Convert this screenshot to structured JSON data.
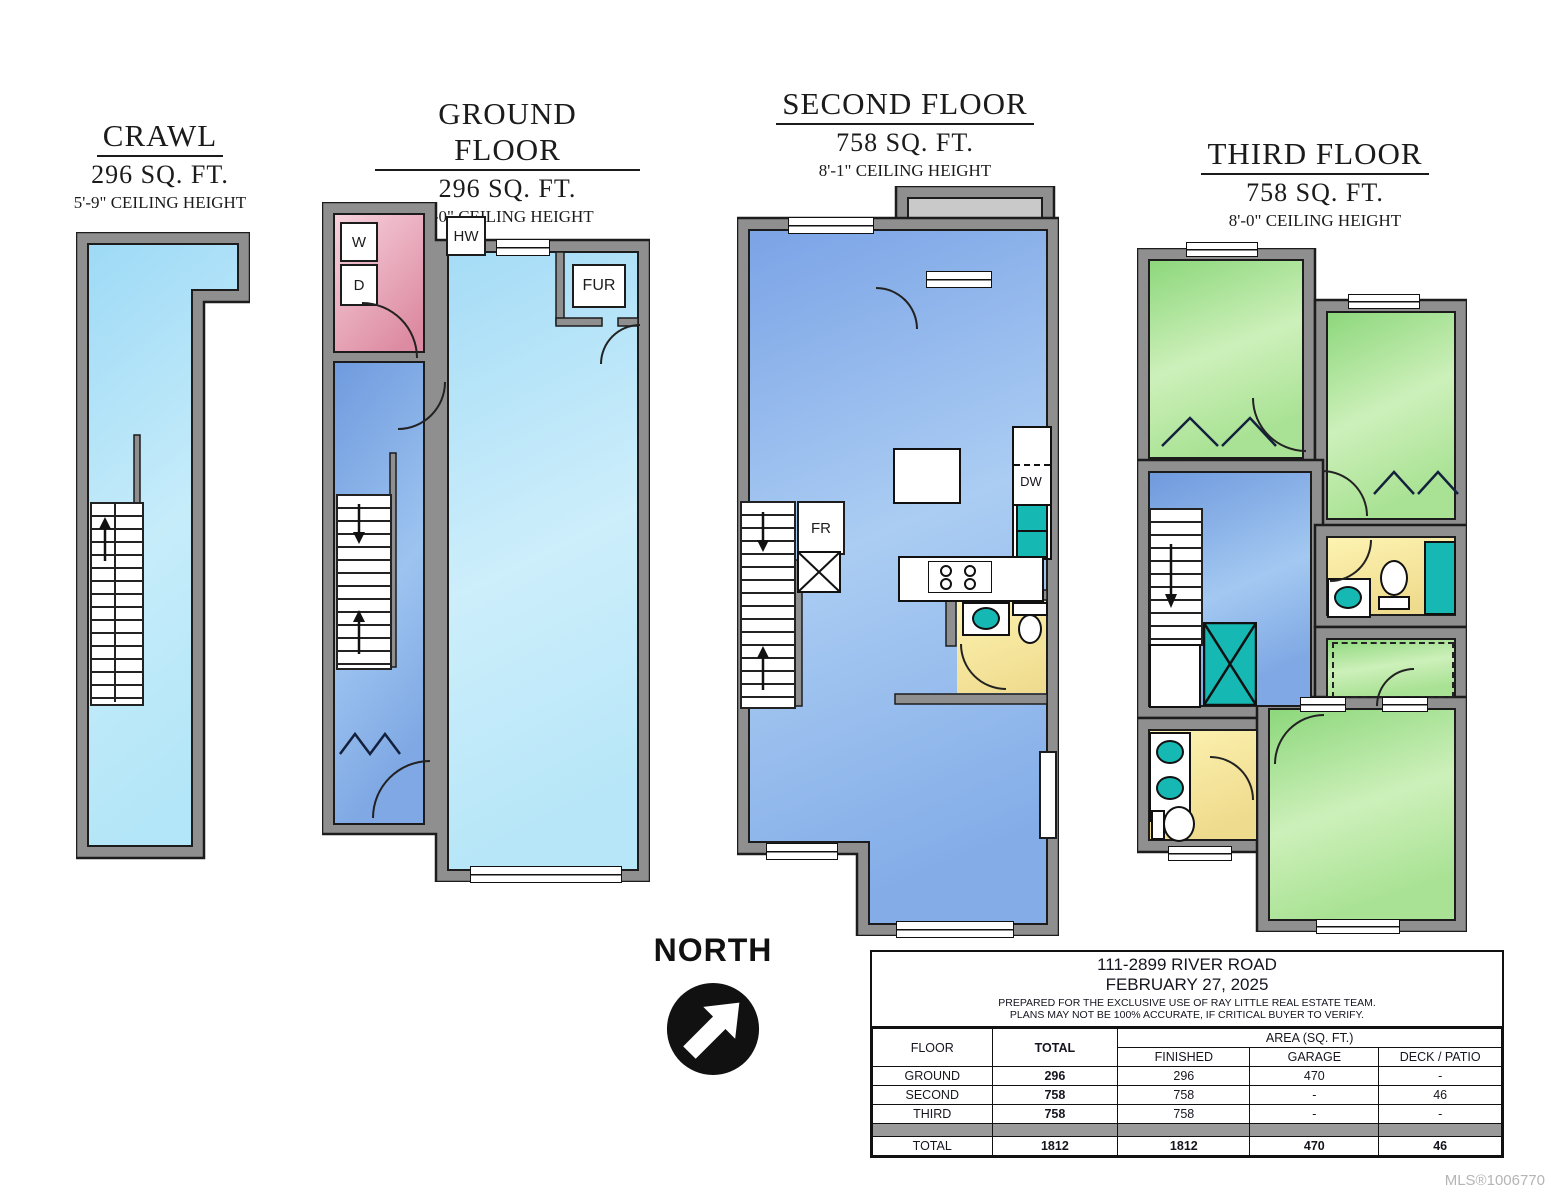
{
  "colors": {
    "wall": "#8f8f8f",
    "teal": "#16b8b4",
    "spacer": "#9a9a9a",
    "crawl_blue": "#a9def7",
    "garage_blue": "#b2e4f8",
    "stair_blue": "#7fa6e2",
    "floor_blue": "#8fb5ec",
    "laundry_pink": "#eeb0c2",
    "bedroom_green": "#a5e18f",
    "bath_yellow": "#f6e9a6",
    "deck_gray": "#c9c9c9"
  },
  "floors": {
    "crawl": {
      "title": "CRAWL",
      "area": "296 SQ. FT.",
      "ceiling": "5'-9\" CEILING HEIGHT",
      "rooms": {
        "crawl_space": {
          "name": "CRAWL SPACE",
          "dims": "6'-5\" x 36'-9\"",
          "note": "5'-9\" CEILING"
        }
      }
    },
    "ground": {
      "title": "GROUND FLOOR",
      "area": "296 SQ. FT.",
      "ceiling": "8'-0\" CEILING HEIGHT",
      "labels": {
        "washer": "W",
        "dryer": "D",
        "hot_water": "HW",
        "furnace": "FUR",
        "dn_to_cr": "DN\nTO\nCR",
        "up": "UP"
      },
      "rooms": {
        "laundry": {
          "name": "LAUNDRY ROOM",
          "dims": "6'-5\" x 9'-0\""
        },
        "entry": {
          "name": "ENTRY",
          "dims": "4'-4\" x 9'-6\""
        },
        "garage": {
          "name": "GARAGE",
          "dims": "11'-10\" x 32'-4\"/36'-9\""
        }
      }
    },
    "second": {
      "title": "SECOND FLOOR",
      "area": "758 SQ. FT.",
      "ceiling": "8'-1\" CEILING HEIGHT",
      "labels": {
        "dn": "DN",
        "up": "UP",
        "fridge": "FR",
        "dishwasher": "DW",
        "fireplace": "FP",
        "half_bath": "2\nPC."
      },
      "rooms": {
        "deck": {
          "name": "DECK",
          "dims": "9'-0\" x 5'-2\""
        },
        "office_nook": {
          "name": "OFFICE NOOK",
          "dims": "9'-0\" x 12'-0\""
        },
        "dining": {
          "name": "DINING ROOM",
          "dims": "9'-6\" x 9'-0\""
        },
        "kitchen": {
          "name": "KITCHEN",
          "dims": "15'-0\" x 9'-7\""
        },
        "living": {
          "name": "LIVING ROOM",
          "dims": "18'-5\"/11'-5\" x 12'-5\""
        }
      }
    },
    "third": {
      "title": "THIRD FLOOR",
      "area": "758 SQ. FT.",
      "ceiling": "8'-0\" CEILING HEIGHT",
      "labels": {
        "dn": "DN",
        "bath": "4 PC.\nBATH",
        "ensuite": "4 PC.\nENS."
      },
      "rooms": {
        "bedroom1": {
          "name": "BEDROOM",
          "dims": "9'-3\" x 10'-3\""
        },
        "bedroom2": {
          "name": "BEDROOM",
          "dims": "9'-1\" x 10'-10\"",
          "note": "8'-1\" CEILING"
        },
        "hallway": {
          "name": "HALLWAY",
          "dims": "10'-4\" x 12'-1\""
        },
        "walk_in_closet": {
          "name": "WALK\nIN\nCLOSET",
          "dims": "6'-0\" x 5'-0\""
        },
        "primary": {
          "name": "PRIMARY BEDROOM",
          "dims": "12'-0\" x 12'-6\""
        }
      }
    }
  },
  "compass": {
    "label": "NORTH"
  },
  "mls": "MLS®1006770",
  "table": {
    "title_line1": "111-2899 RIVER ROAD",
    "title_line2": "FEBRUARY 27, 2025",
    "title_line3": "PREPARED FOR THE EXCLUSIVE USE OF RAY LITTLE REAL ESTATE TEAM.",
    "title_line4": "PLANS MAY NOT BE 100% ACCURATE, IF CRITICAL BUYER TO VERIFY.",
    "col_floor": "FLOOR",
    "col_total": "TOTAL",
    "col_area": "AREA (SQ. FT.)",
    "col_finished": "FINISHED",
    "col_garage": "GARAGE",
    "col_deck": "DECK / PATIO",
    "rows": [
      {
        "floor": "GROUND",
        "total": "296",
        "finished": "296",
        "garage": "470",
        "deck": "-"
      },
      {
        "floor": "SECOND",
        "total": "758",
        "finished": "758",
        "garage": "-",
        "deck": "46"
      },
      {
        "floor": "THIRD",
        "total": "758",
        "finished": "758",
        "garage": "-",
        "deck": "-"
      }
    ],
    "total_row": {
      "floor": "TOTAL",
      "total": "1812",
      "finished": "1812",
      "garage": "470",
      "deck": "46"
    }
  }
}
